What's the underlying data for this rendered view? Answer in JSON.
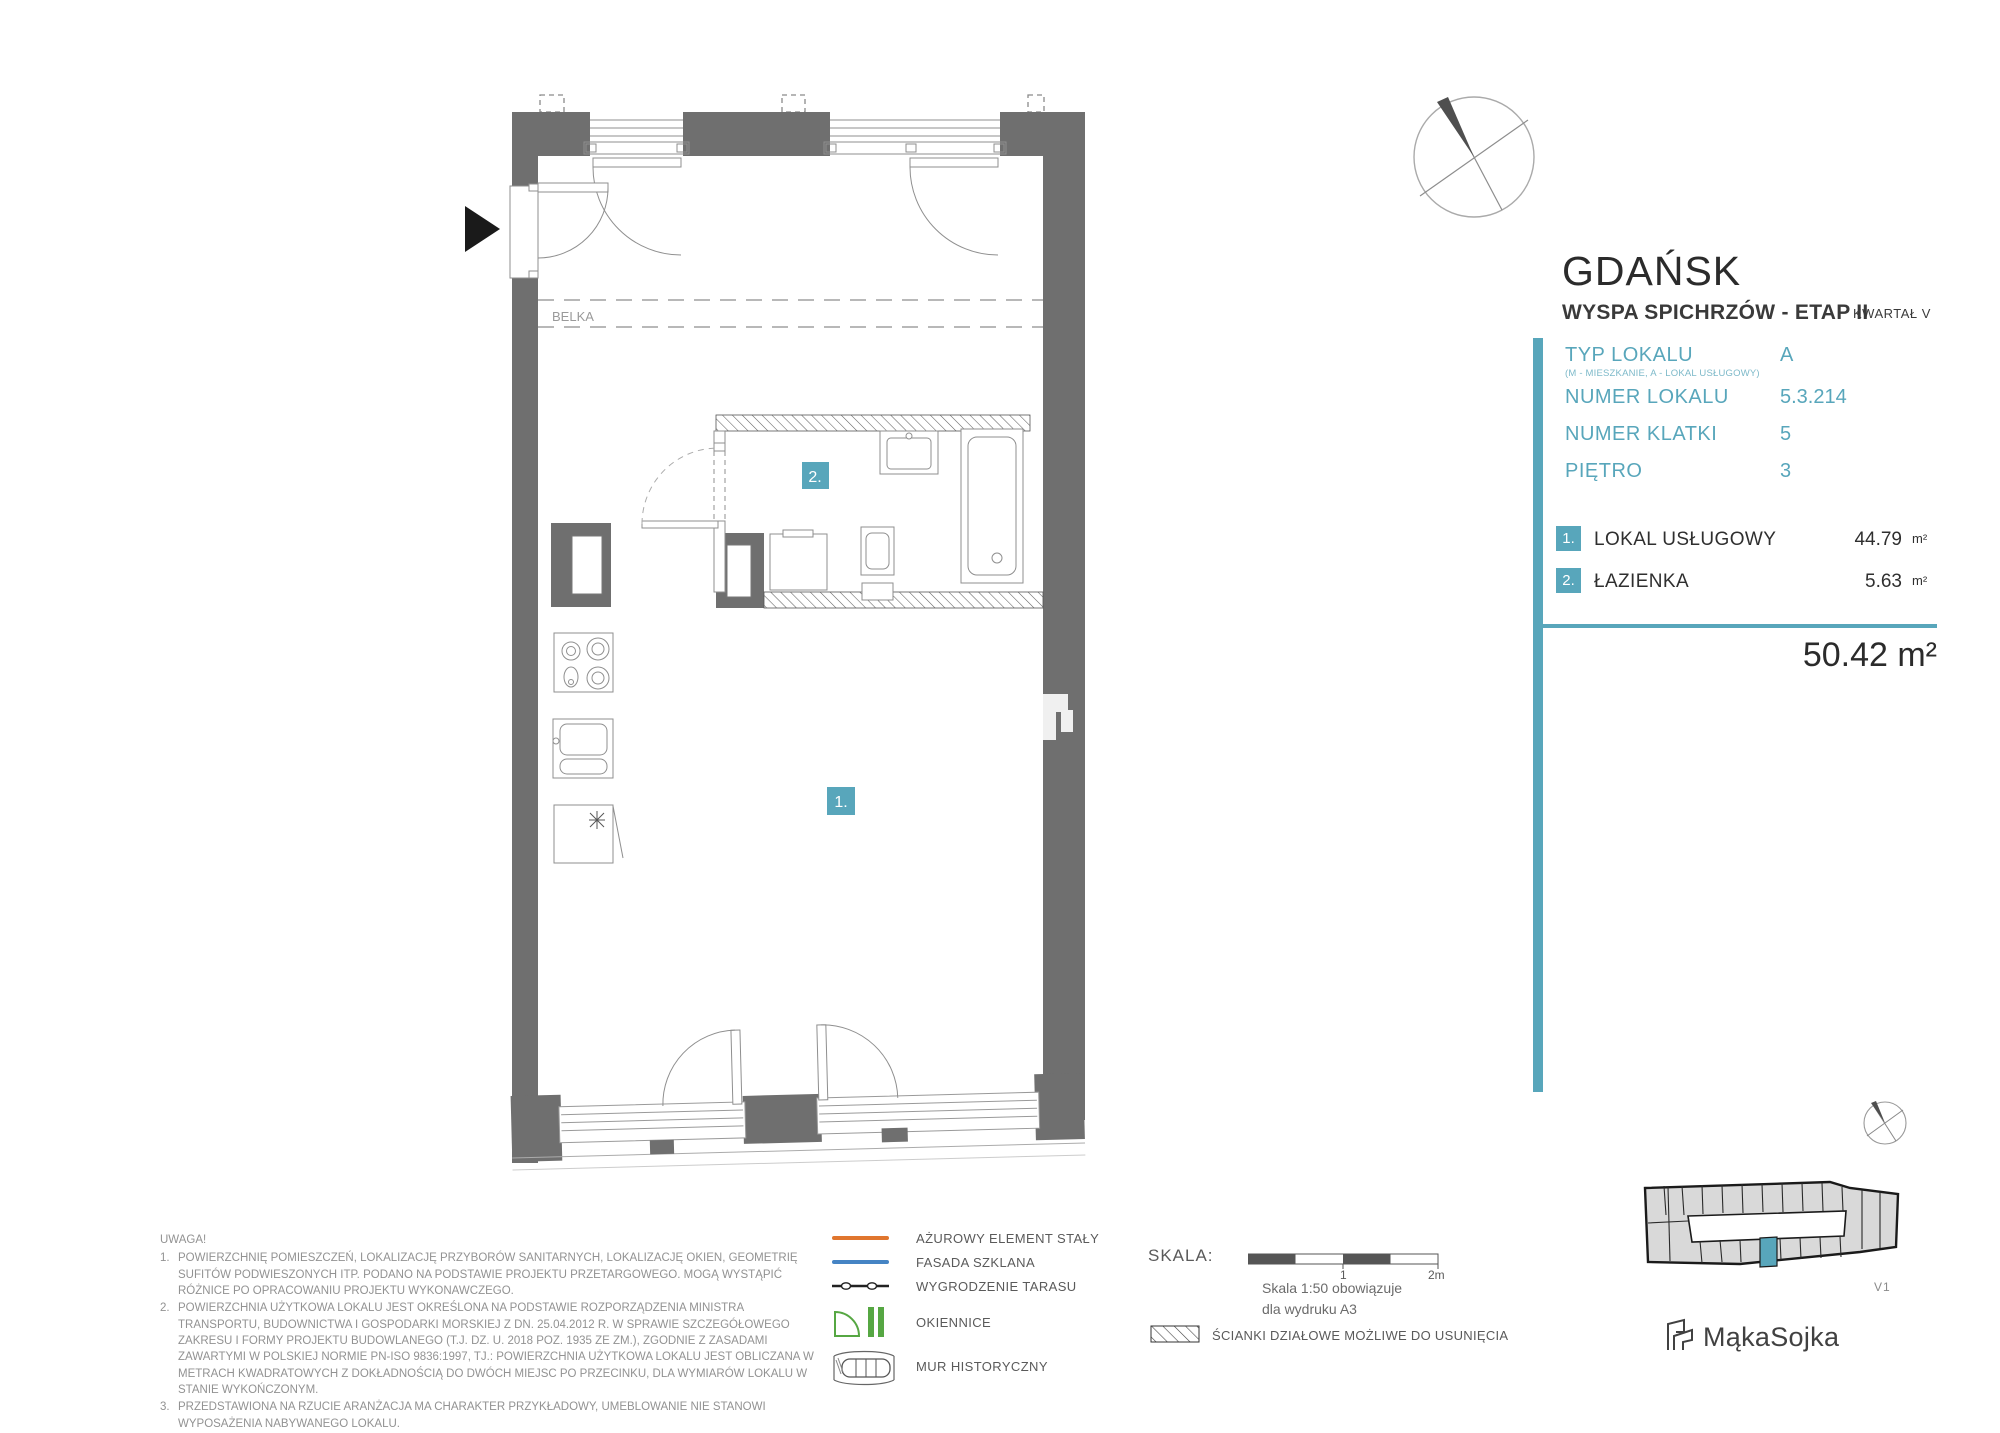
{
  "header": {
    "city": "GDAŃSK",
    "project": "WYSPA SPICHRZÓW - ETAP II",
    "quarter": "KWARTAŁ V"
  },
  "info": {
    "rows": [
      {
        "label": "TYP LOKALU",
        "sub": "(M - MIESZKANIE, A - LOKAL USŁUGOWY)",
        "value": "A"
      },
      {
        "label": "NUMER LOKALU",
        "sub": "",
        "value": "5.3.214"
      },
      {
        "label": "NUMER KLATKI",
        "sub": "",
        "value": "5"
      },
      {
        "label": "PIĘTRO",
        "sub": "",
        "value": "3"
      }
    ]
  },
  "rooms": [
    {
      "num": "1.",
      "name": "LOKAL USŁUGOWY",
      "area": "44.79",
      "unit": "m²"
    },
    {
      "num": "2.",
      "name": "ŁAZIENKA",
      "area": "5.63",
      "unit": "m²"
    }
  ],
  "total": {
    "area": "50.42 m²"
  },
  "plan": {
    "beam_label": "BELKA",
    "room1_badge": "1.",
    "room2_badge": "2."
  },
  "notes": {
    "title": "UWAGA!",
    "items": [
      "POWIERZCHNIĘ POMIESZCZEŃ, LOKALIZACJĘ PRZYBORÓW SANITARNYCH, LOKALIZACJĘ OKIEN, GEOMETRIĘ SUFITÓW PODWIESZONYCH  ITP. PODANO NA PODSTAWIE PROJEKTU PRZETARGOWEGO. MOGĄ WYSTĄPIĆ  RÓŻNICE PO OPRACOWANIU PROJEKTU WYKONAWCZEGO.",
      "POWIERZCHNIA UŻYTKOWA LOKALU JEST OKREŚLONA NA PODSTAWIE ROZPORZĄDZENIA MINISTRA TRANSPORTU, BUDOWNICTWA I GOSPODARKI MORSKIEJ Z DN. 25.04.2012 R. W  SPRAWIE SZCZEGÓŁOWEGO ZAKRESU I FORMY PROJEKTU BUDOWLANEGO (T.J. DZ. U. 2018 POZ. 1935 ZE ZM.), ZGODNIE Z ZASADAMI ZAWARTYMI W POLSKIEJ NORMIE PN-ISO 9836:1997, TJ.: POWIERZCHNIA UŻYTKOWA LOKALU JEST OBLICZANA W METRACH KWADRATOWYCH Z DOKŁADNOŚCIĄ DO DWÓCH MIEJSC PO PRZECINKU, DLA WYMIARÓW LOKALU W STANIE WYKOŃCZONYM.",
      "PRZEDSTAWIONA NA RZUCIE ARANŻACJA MA CHARAKTER PRZYKŁADOWY, UMEBLOWANIE NIE STANOWI WYPOSAŻENIA NABYWANEGO LOKALU."
    ]
  },
  "legend": {
    "items": [
      {
        "label": "AŻUROWY ELEMENT STAŁY"
      },
      {
        "label": "FASADA SZKLANA"
      },
      {
        "label": "WYGRODZENIE TARASU"
      },
      {
        "label": "OKIENNICE"
      },
      {
        "label": "MUR HISTORYCZNY"
      }
    ]
  },
  "scale": {
    "label": "SKALA:",
    "tick_mid": "1",
    "tick_end": "2m",
    "note_line1": "Skala 1:50 obowiązuje",
    "note_line2": "dla wydruku A3",
    "partition_label": "ŚCIANKI DZIAŁOWE MOŻLIWE DO USUNIĘCIA"
  },
  "footer": {
    "plan_version": "V1",
    "logo_text": "MąkaSojka"
  },
  "colors": {
    "accent": "#58a6bb",
    "wall": "#6f6f6f",
    "legend_orange": "#e0762e",
    "legend_blue": "#4584c4",
    "legend_green": "#56a743"
  }
}
